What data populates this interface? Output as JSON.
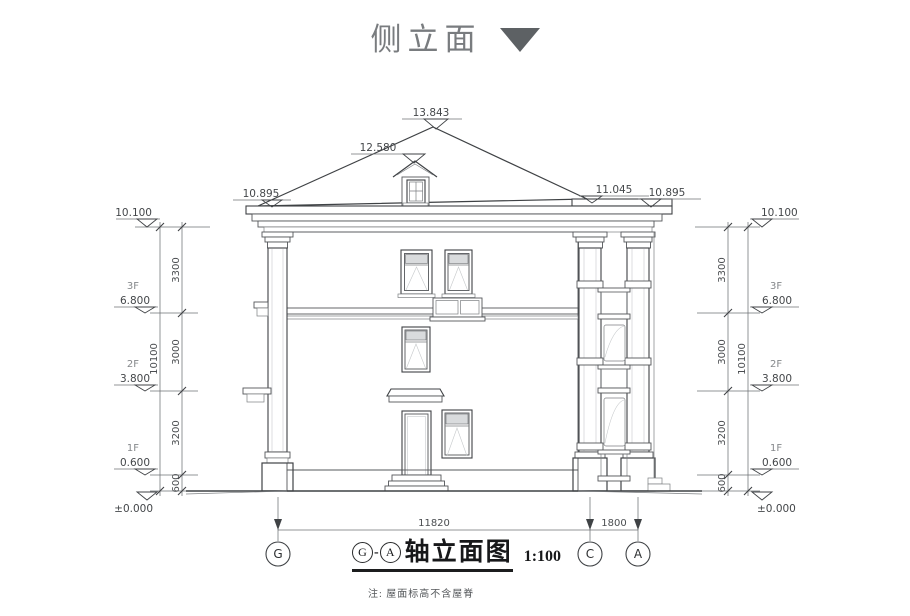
{
  "header": {
    "title": "侧立面"
  },
  "drawing": {
    "roof_marks": {
      "ridge": "13.843",
      "dormer_ridge": "12.580",
      "eave_left": "10.895",
      "cornice_right": "11.045",
      "eave_right": "10.895"
    },
    "levels": {
      "top": "10.100",
      "f3": "6.800",
      "f2": "3.800",
      "f1": "0.600",
      "ground": "±0.000"
    },
    "floors": {
      "f3": "3F",
      "f2": "2F",
      "f1": "1F"
    },
    "vdims": {
      "total": "10100",
      "top": "3300",
      "mid": "3000",
      "low": "3200",
      "plinth": "600"
    },
    "hdims": {
      "g_c": "11820",
      "c_a": "1800"
    },
    "axes": {
      "g": "G",
      "c": "C",
      "a": "A"
    }
  },
  "caption": {
    "from": "G",
    "dash": "-",
    "to": "A",
    "title": "轴立面图",
    "scale": "1:100"
  },
  "note": {
    "text": "注: 屋面标高不含屋脊"
  }
}
